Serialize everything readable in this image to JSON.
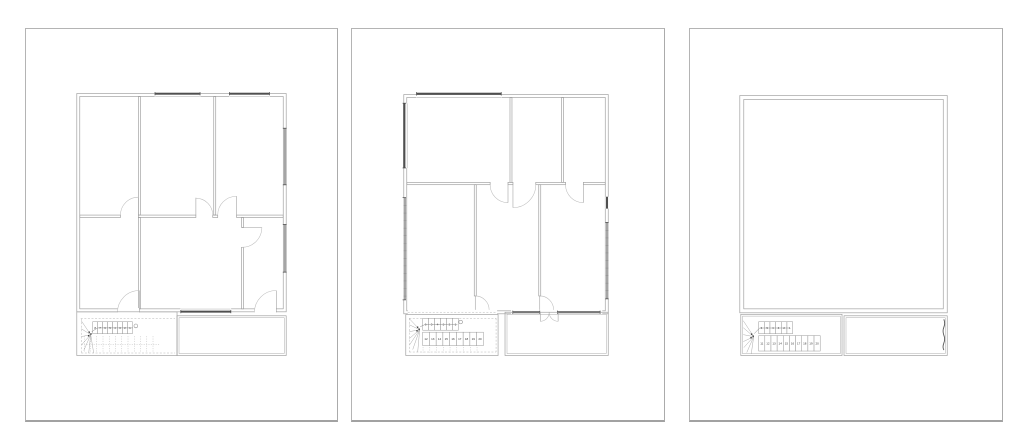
{
  "colors": {
    "background": "#ffffff",
    "sheet_border": "#b4b4b4",
    "wall_line": "#9b9b9b",
    "door_arc": "#bcbcbc",
    "window_dark": "#4f4f4f",
    "window_gray": "#a5a5a5",
    "dashed_line": "#b3b3b3",
    "stair_number": "#333333"
  },
  "sheets": [
    {
      "id": "floor-plan-left",
      "stair": {
        "flight1_numbers": [
          "8",
          "7",
          "6",
          "5",
          "4",
          "3",
          "2",
          "1"
        ],
        "flight2_numbers": []
      }
    },
    {
      "id": "floor-plan-middle",
      "stair": {
        "flight1_numbers": [
          "6",
          "5",
          "4",
          "3",
          "2",
          "1"
        ],
        "flight2_numbers": [
          "12",
          "13",
          "14",
          "15",
          "16",
          "17",
          "18",
          "19",
          "20"
        ]
      }
    },
    {
      "id": "floor-plan-right",
      "stair": {
        "flight1_numbers": [
          "6",
          "5",
          "4",
          "3",
          "2",
          "1"
        ],
        "flight2_numbers": [
          "11",
          "12",
          "13",
          "14",
          "15",
          "16",
          "17",
          "18",
          "19",
          "20"
        ]
      }
    }
  ]
}
